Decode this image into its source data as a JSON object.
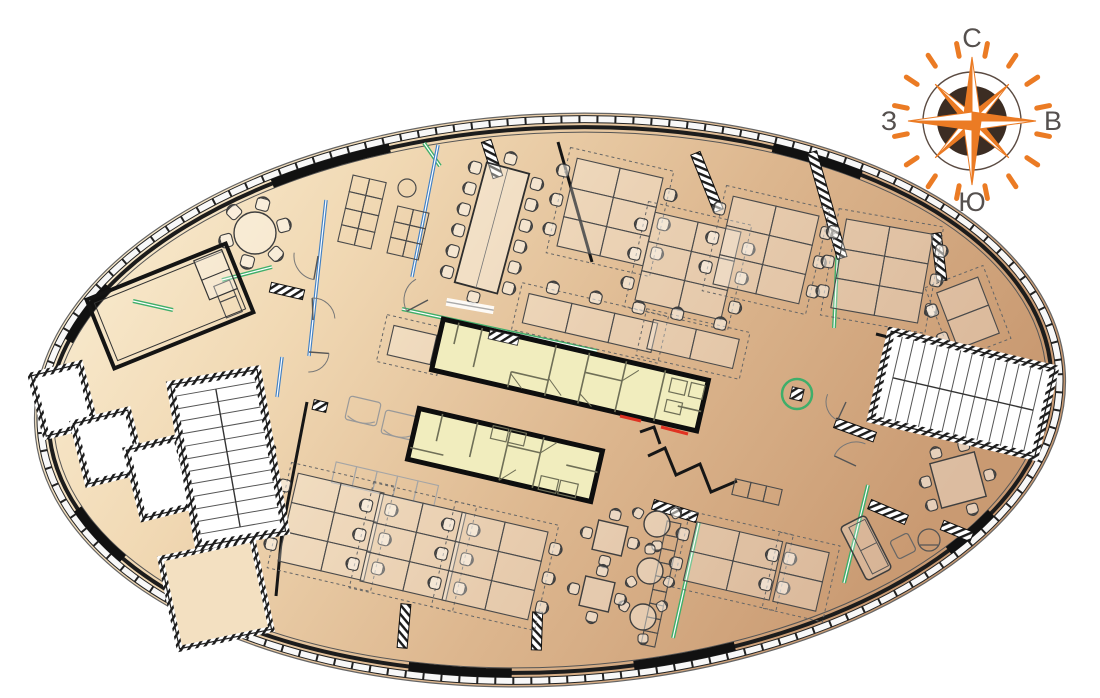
{
  "meta": {
    "type": "office-floor-plan",
    "description": "elliptical office floor plan with compass rose"
  },
  "compass": {
    "cx": 972,
    "cy": 121,
    "disc_r": 35,
    "ring_r": 49,
    "main_r": 64,
    "diag_r": 52,
    "main_hw": 9,
    "diag_hw": 6.5,
    "dash_in": 66,
    "dash_out": 79,
    "labels": {
      "north": "С",
      "east": "В",
      "south": "Ю",
      "west": "З"
    }
  },
  "colors": {
    "floor_light": "#FCF3DB",
    "floor_mid1": "#F1D9B4",
    "floor_mid2": "#DDB78F",
    "floor_dark": "#C99A72",
    "core_fill": "#F1EDBE",
    "core_line": "#6F6F57",
    "glass_green": "#3FAE6A",
    "glass_blue": "#4080C4",
    "accent_red": "#E03222",
    "wall": "#161616",
    "furniture": "#3F3F3F",
    "faint": "#A5A5A5",
    "compass_orange": "#EB7B24",
    "compass_disc": "#3C2D23",
    "compass_ring": "#5B4B42",
    "compass_label": "#55504E",
    "tip_fill": "#F3E0C1"
  },
  "plan": {
    "ellipse": {
      "cx": 550,
      "cy": 400,
      "rx": 516,
      "ry": 286,
      "rot": -3
    },
    "facade_solid_arcs": [
      [
        -122,
        -106
      ],
      [
        -62,
        -48
      ],
      [
        -162,
        -150
      ],
      [
        96,
        108
      ],
      [
        70,
        82
      ],
      [
        150,
        163
      ],
      [
        30,
        40
      ]
    ],
    "left_core": {
      "boxes": [
        {
          "x": 63,
          "y": 400,
          "w": 50,
          "h": 62,
          "rot": -14
        },
        {
          "x": 108,
          "y": 447,
          "w": 56,
          "h": 62,
          "rot": -14
        },
        {
          "x": 160,
          "y": 478,
          "w": 52,
          "h": 70,
          "rot": -14
        }
      ],
      "tip": {
        "x": 216,
        "y": 594,
        "w": 94,
        "h": 92,
        "rot": -12
      }
    },
    "stairs": [
      {
        "x": 228,
        "y": 458,
        "w": 88,
        "h": 164,
        "rot": -10,
        "treads": 11,
        "axis": "v"
      },
      {
        "x": 963,
        "y": 394,
        "w": 168,
        "h": 90,
        "rot": 13,
        "treads": 12,
        "axis": "h"
      }
    ],
    "cores": {
      "a": {
        "x": 570,
        "y": 375,
        "w": 272,
        "h": 52,
        "rot": 13,
        "segs": [
          [
            -120,
            -26,
            -120,
            -4
          ],
          [
            -96,
            -26,
            -96,
            14
          ],
          [
            -58,
            10,
            -58,
            26
          ],
          [
            -58,
            10,
            -20,
            10
          ],
          [
            -20,
            -26,
            -20,
            26
          ],
          [
            14,
            -26,
            14,
            26
          ],
          [
            14,
            -6,
            52,
            -6
          ],
          [
            52,
            -26,
            52,
            26
          ],
          [
            92,
            -26,
            92,
            26
          ],
          [
            112,
            6,
            136,
            6
          ]
        ],
        "cells": [
          [
            100,
            -20,
            16,
            14
          ],
          [
            100,
            2,
            16,
            12
          ],
          [
            120,
            -20,
            14,
            14
          ]
        ],
        "doors": [
          [
            -20,
            8,
            -4,
            22
          ],
          [
            52,
            -6,
            66,
            -20
          ],
          [
            14,
            16,
            28,
            26
          ],
          [
            -58,
            12,
            -44,
            24
          ]
        ],
        "hatch": [
          [
            -88,
            -26,
            30,
            9
          ]
        ]
      },
      "b": {
        "x": 505,
        "y": 455,
        "w": 188,
        "h": 52,
        "rot": 13,
        "segs": [
          [
            -70,
            -26,
            -70,
            2
          ],
          [
            -34,
            -26,
            -34,
            10
          ],
          [
            0,
            -26,
            0,
            26
          ],
          [
            0,
            -10,
            34,
            -10
          ],
          [
            34,
            -26,
            34,
            26
          ],
          [
            62,
            -4,
            94,
            -4
          ],
          [
            -94,
            14,
            -60,
            14
          ]
        ],
        "cells": [
          [
            -18,
            -26,
            16,
            13
          ],
          [
            0,
            -26,
            16,
            13
          ],
          [
            40,
            12,
            18,
            14
          ],
          [
            60,
            12,
            18,
            14
          ]
        ],
        "doors": [
          [
            0,
            26,
            14,
            12
          ],
          [
            34,
            -10,
            48,
            -24
          ]
        ],
        "hatch": []
      }
    },
    "meeting_room": {
      "x": 170,
      "y": 306,
      "rot": -22,
      "w": 150,
      "h": 74
    },
    "desk_clusters": [
      {
        "x": 610,
        "y": 212,
        "rot": 13,
        "cols": 2,
        "rows": 3
      },
      {
        "x": 688,
        "y": 266,
        "rot": 13,
        "cols": 2,
        "rows": 3
      },
      {
        "x": 766,
        "y": 250,
        "rot": 13,
        "cols": 2,
        "rows": 3
      },
      {
        "x": 590,
        "y": 323,
        "rot": 13,
        "cols": 3,
        "rows": 1,
        "side": "top"
      },
      {
        "x": 693,
        "y": 344,
        "rot": 13,
        "cols": 2,
        "rows": 1,
        "side": "top"
      },
      {
        "x": 882,
        "y": 271,
        "rot": 10,
        "cols": 2,
        "rows": 3
      },
      {
        "x": 968,
        "y": 313,
        "rot": -21,
        "cols": 1,
        "rows": 2,
        "side": "left"
      },
      {
        "x": 331,
        "y": 527,
        "rot": 13,
        "cols": 2,
        "rows": 3
      },
      {
        "x": 413,
        "y": 547,
        "rot": 13,
        "cols": 2,
        "rows": 3
      },
      {
        "x": 495,
        "y": 566,
        "rot": 13,
        "cols": 2,
        "rows": 3
      },
      {
        "x": 733,
        "y": 561,
        "rot": 13,
        "cols": 2,
        "rows": 2
      },
      {
        "x": 801,
        "y": 577,
        "rot": 13,
        "cols": 1,
        "rows": 2,
        "side": "left"
      },
      {
        "x": 412,
        "y": 345,
        "rot": 13,
        "cols": 1,
        "rows": 1,
        "side": "right"
      }
    ],
    "round_tables": [
      {
        "x": 255,
        "y": 233,
        "r": 21,
        "chairs": 6,
        "start": -15,
        "cs": 13
      },
      {
        "x": 657,
        "y": 524,
        "r": 13,
        "chairs": 3,
        "start": 210,
        "cs": 10
      },
      {
        "x": 650,
        "y": 571,
        "r": 13,
        "chairs": 3,
        "start": 150,
        "cs": 10
      },
      {
        "x": 643,
        "y": 617,
        "r": 13,
        "chairs": 3,
        "start": 90,
        "cs": 10
      }
    ],
    "square_tables": [
      {
        "x": 610,
        "y": 538,
        "s": 30,
        "rot": 13,
        "chairs": 4
      },
      {
        "x": 597,
        "y": 594,
        "s": 30,
        "rot": 13,
        "chairs": 4
      },
      {
        "x": 958,
        "y": 480,
        "s": 46,
        "rot": -15,
        "chairs": 6
      }
    ],
    "conference": {
      "x": 492,
      "y": 228,
      "w": 44,
      "h": 124,
      "rot": 15,
      "side_chairs": 6
    },
    "shelves": [
      {
        "x": 362,
        "y": 212,
        "rot": 13,
        "cols": 2,
        "rows": 4,
        "cell": 17
      },
      {
        "x": 408,
        "y": 233,
        "rot": 13,
        "cols": 2,
        "rows": 3,
        "cell": 16
      },
      {
        "x": 228,
        "y": 299,
        "rot": -22,
        "cols": 1,
        "rows": 2,
        "cell": 17
      },
      {
        "x": 661,
        "y": 584,
        "rot": 12,
        "cols": 1,
        "rows": 9,
        "cell": 14
      },
      {
        "x": 757,
        "y": 492,
        "rot": 13,
        "cols": 3,
        "rows": 1,
        "cell": 16
      },
      {
        "x": 385,
        "y": 484,
        "rot": 13,
        "cols": 5,
        "rows": 1,
        "cell": 21,
        "faint": true
      }
    ],
    "stools": [
      [
        407,
        188,
        9
      ]
    ],
    "glass_green": [
      [
        222,
        280,
        272,
        267
      ],
      [
        133,
        301,
        173,
        310
      ],
      [
        424,
        143,
        440,
        166
      ],
      [
        402,
        309,
        597,
        351
      ],
      [
        838,
        243,
        834,
        328
      ],
      [
        699,
        522,
        673,
        638
      ],
      [
        868,
        485,
        844,
        583
      ],
      [
        230,
        597,
        252,
        619
      ]
    ],
    "glass_blue": [
      [
        326,
        200,
        309,
        356
      ],
      [
        438,
        145,
        412,
        277
      ],
      [
        282,
        357,
        277,
        397
      ]
    ],
    "red_ticks": [
      [
        620,
        416,
        641,
        421
      ],
      [
        661,
        427,
        688,
        434
      ]
    ],
    "walls": [
      [
        558,
        142,
        592,
        262
      ],
      [
        307,
        402,
        282,
        532
      ],
      [
        282,
        532,
        276,
        596
      ],
      [
        228,
        463,
        276,
        447
      ],
      [
        876,
        334,
        908,
        342
      ],
      [
        908,
        342,
        902,
        362
      ],
      [
        838,
        422,
        866,
        434
      ]
    ],
    "wall_stubs": [
      {
        "x": 492,
        "y": 159,
        "len": 38,
        "rot": 72
      },
      {
        "x": 707,
        "y": 182,
        "len": 62,
        "rot": 68
      },
      {
        "x": 827,
        "y": 205,
        "len": 110,
        "rot": 74
      },
      {
        "x": 939,
        "y": 257,
        "len": 48,
        "rot": 83
      },
      {
        "x": 404,
        "y": 626,
        "len": 44,
        "rot": 95
      },
      {
        "x": 537,
        "y": 631,
        "len": 38,
        "rot": 92
      },
      {
        "x": 675,
        "y": 511,
        "len": 46,
        "rot": 17
      },
      {
        "x": 888,
        "y": 512,
        "len": 40,
        "rot": 23
      },
      {
        "x": 957,
        "y": 531,
        "len": 32,
        "rot": 22
      },
      {
        "x": 855,
        "y": 430,
        "len": 42,
        "rot": 20
      },
      {
        "x": 287,
        "y": 291,
        "len": 34,
        "rot": 13
      },
      {
        "x": 320,
        "y": 406,
        "len": 14,
        "rot": 13
      }
    ],
    "door_arcs": [
      {
        "x": 318,
        "y": 256,
        "r": 24,
        "a0": 100,
        "a1": 188
      },
      {
        "x": 313,
        "y": 320,
        "r": 22,
        "a0": 268,
        "a1": 356
      },
      {
        "x": 309,
        "y": 352,
        "r": 20,
        "a0": 4,
        "a1": 92
      },
      {
        "x": 428,
        "y": 300,
        "r": 24,
        "a0": 152,
        "a1": 240
      },
      {
        "x": 856,
        "y": 466,
        "r": 24,
        "a0": 205,
        "a1": 293
      },
      {
        "x": 846,
        "y": 402,
        "r": 20,
        "a0": 115,
        "a1": 203
      },
      {
        "x": 247,
        "y": 517,
        "r": 19,
        "a0": 182,
        "a1": 268
      }
    ],
    "zigzags": [
      [
        "648,456",
        "665,448",
        "676,475",
        "700,464",
        "711,492",
        "737,481"
      ],
      [
        "640,432",
        "654,427",
        "660,444"
      ]
    ],
    "gray_sofas": [
      {
        "x": 363,
        "y": 411,
        "rot": 13
      },
      {
        "x": 399,
        "y": 425,
        "rot": 13
      }
    ],
    "lounge": {
      "sofa": {
        "x": 866,
        "y": 548,
        "rot": -27
      },
      "ottoman": {
        "x": 903,
        "y": 546,
        "rot": -27,
        "s": 20
      },
      "armchair": {
        "x": 929,
        "y": 540,
        "r": 11
      }
    },
    "white_bar": {
      "x": 470,
      "y": 306,
      "rot": 10,
      "w": 48,
      "h": 8
    },
    "green_circle": {
      "x": 797,
      "y": 394,
      "r": 15
    }
  }
}
